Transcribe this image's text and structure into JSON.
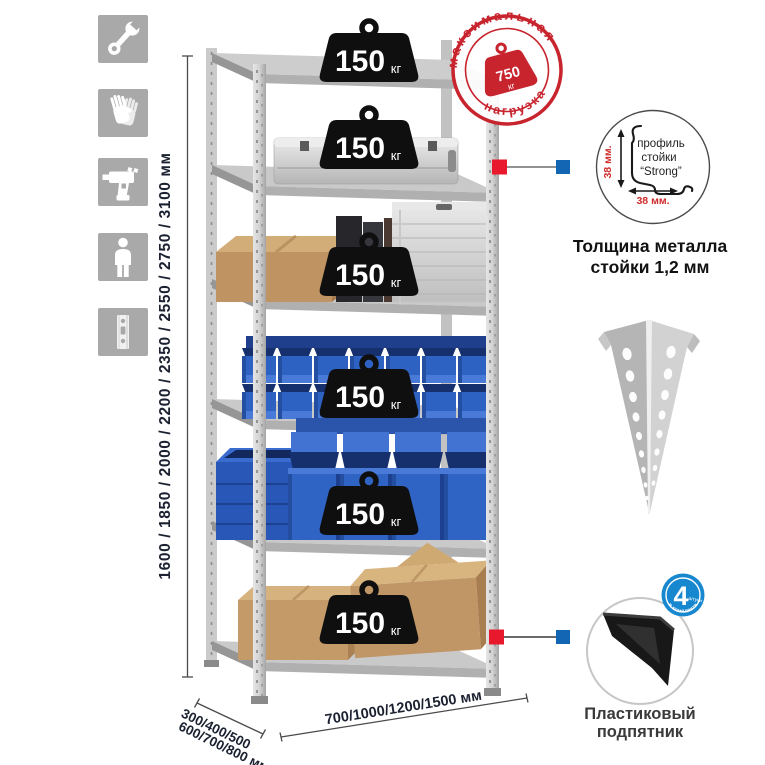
{
  "left_icons": [
    "wrench",
    "gloves",
    "drill",
    "person",
    "rack-post"
  ],
  "height_dimension": {
    "label": "1600 / 1850 / 2000 / 2200 / 2350 / 2550 / 2750 / 3100 мм"
  },
  "shelf_badges": [
    {
      "value": "150",
      "unit": "кг"
    },
    {
      "value": "150",
      "unit": "кг"
    },
    {
      "value": "150",
      "unit": "кг"
    },
    {
      "value": "150",
      "unit": "кг"
    },
    {
      "value": "150",
      "unit": "кг"
    },
    {
      "value": "150",
      "unit": "кг"
    }
  ],
  "max_load_stamp": {
    "arc_top": "максимальная",
    "arc_bottom": "нагрузка",
    "value": "750",
    "unit": "кг"
  },
  "profile_detail": {
    "label_line1": "профиль",
    "label_line2": "стойки",
    "label_line3": "“Strong”",
    "vertical_dim": "38 мм.",
    "horizontal_dim": "38 мм.",
    "caption_line1": "Толщина металла",
    "caption_line2": "стойки 1,2 мм"
  },
  "foot_detail": {
    "badge_number": "4",
    "badge_unit": "штуки",
    "badge_arc": "в комплекте",
    "caption_line1": "Пластиковый",
    "caption_line2": "подпятник"
  },
  "bottom_dimensions": {
    "depth_line1": "300/400/500",
    "depth_line2": "600/700/800 мм",
    "width_label": "700/1000/1200/1500 мм"
  },
  "colors": {
    "accent_red": "#c8242e",
    "marker_red": "#e8192c",
    "marker_blue": "#1266b3",
    "badge_blue": "#1787cf",
    "bin_blue": "#2f63c4",
    "icon_gray": "#a9a9a9",
    "dim_text": "#1b2130"
  }
}
